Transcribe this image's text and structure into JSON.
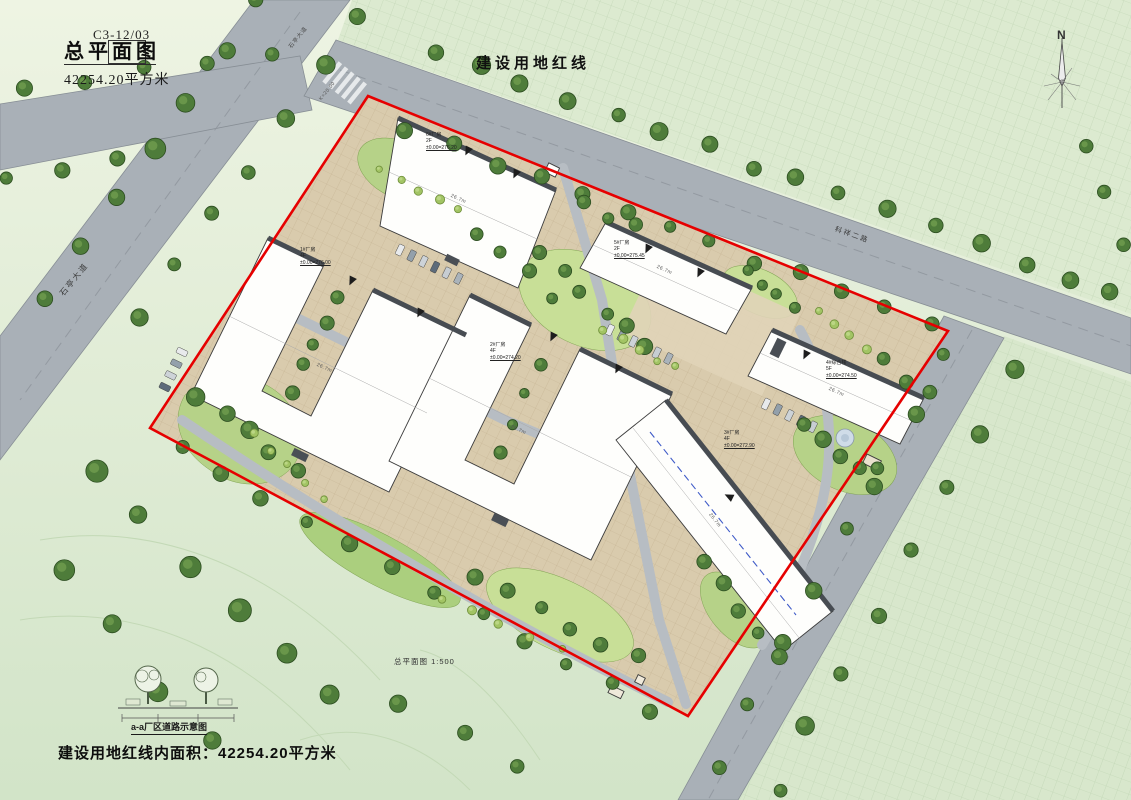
{
  "drawing": {
    "sheet_no": "C3-12/03",
    "title": "总平面图",
    "area_text": "42254.20平方米",
    "scale_note": "总平面图 1:500",
    "red_line_label": "建设用地红线",
    "bottom_note": "建设用地红线内面积：42254.20平方米",
    "legend_caption": "a-a厂区道路示意图",
    "north_label": "N"
  },
  "streets": {
    "west": "石亭大道",
    "north": "科祥二路"
  },
  "buildings": [
    {
      "name": "1#厂房",
      "floors": "4F",
      "elev": "±0.00=276.00"
    },
    {
      "name": "2#厂房",
      "floors": "4F",
      "elev": "±0.00=274.20"
    },
    {
      "name": "3#厂房",
      "floors": "4F",
      "elev": "±0.00=272.90"
    },
    {
      "name": "5#厂房",
      "floors": "2F",
      "elev": "±0.00=275.45"
    },
    {
      "name": "6#厂房",
      "floors": "2F",
      "elev": "±0.00=276.20"
    },
    {
      "name": "4#综合楼",
      "floors": "5F",
      "elev": "±0.00=274.50"
    }
  ],
  "annotations": {
    "roof_dim": "26.7m",
    "road_dim": "K=20.00"
  },
  "colors": {
    "red_line": "#e60000",
    "road": "#a9b0b7",
    "paving": "#d9cbad",
    "tree": "#4f7d3a",
    "building": "#ffffff"
  }
}
